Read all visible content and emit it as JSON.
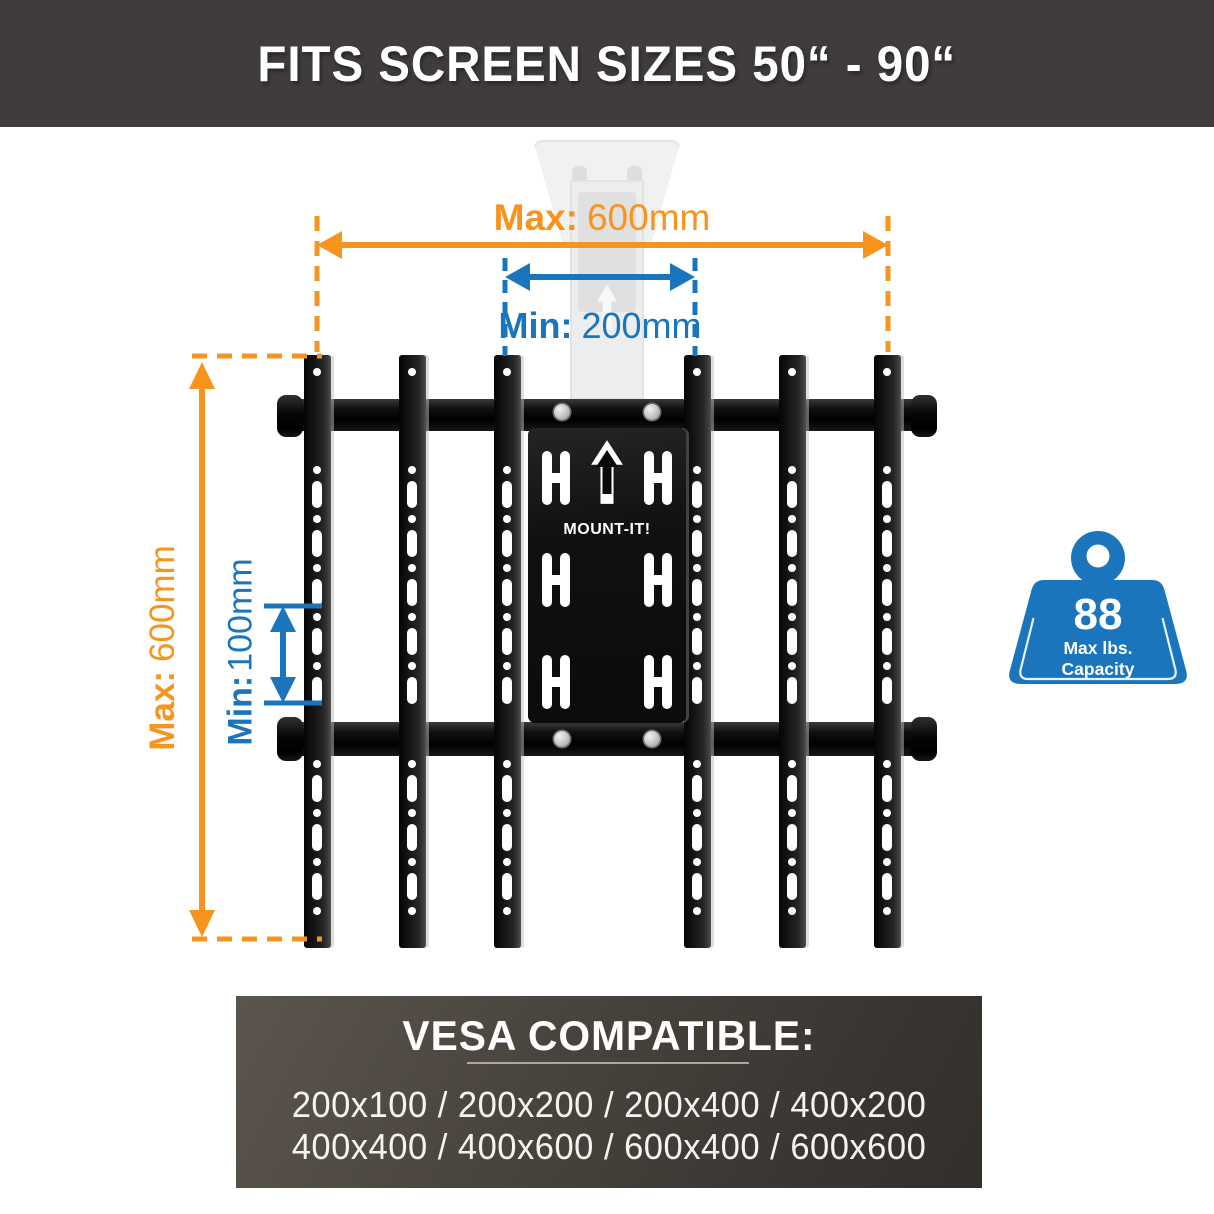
{
  "banner": {
    "title": "FITS SCREEN SIZES 50“ - 90“",
    "background": "#3f3c3b"
  },
  "colors": {
    "accent_orange": "#f7941e",
    "accent_blue": "#1b75bc",
    "bracket_black": "#141414",
    "page_background": "#ffffff"
  },
  "dimensions": {
    "horizontal_max": {
      "label": "Max:",
      "value": "600mm"
    },
    "horizontal_min": {
      "label": "Min:",
      "value": "200mm"
    },
    "vertical_max": {
      "label": "Max:",
      "value": "600mm"
    },
    "vertical_min": {
      "label": "Min:",
      "value": "100mm"
    }
  },
  "bracket": {
    "brand": "MOUNT-IT!"
  },
  "capacity": {
    "value": "88",
    "unit_line1": "Max lbs.",
    "unit_line2": "Capacity"
  },
  "vesa": {
    "title": "VESA COMPATIBLE:",
    "row1": "200x100 / 200x200 / 200x400 / 400x200",
    "row2": "400x400 / 400x600 / 600x400 / 600x600"
  }
}
